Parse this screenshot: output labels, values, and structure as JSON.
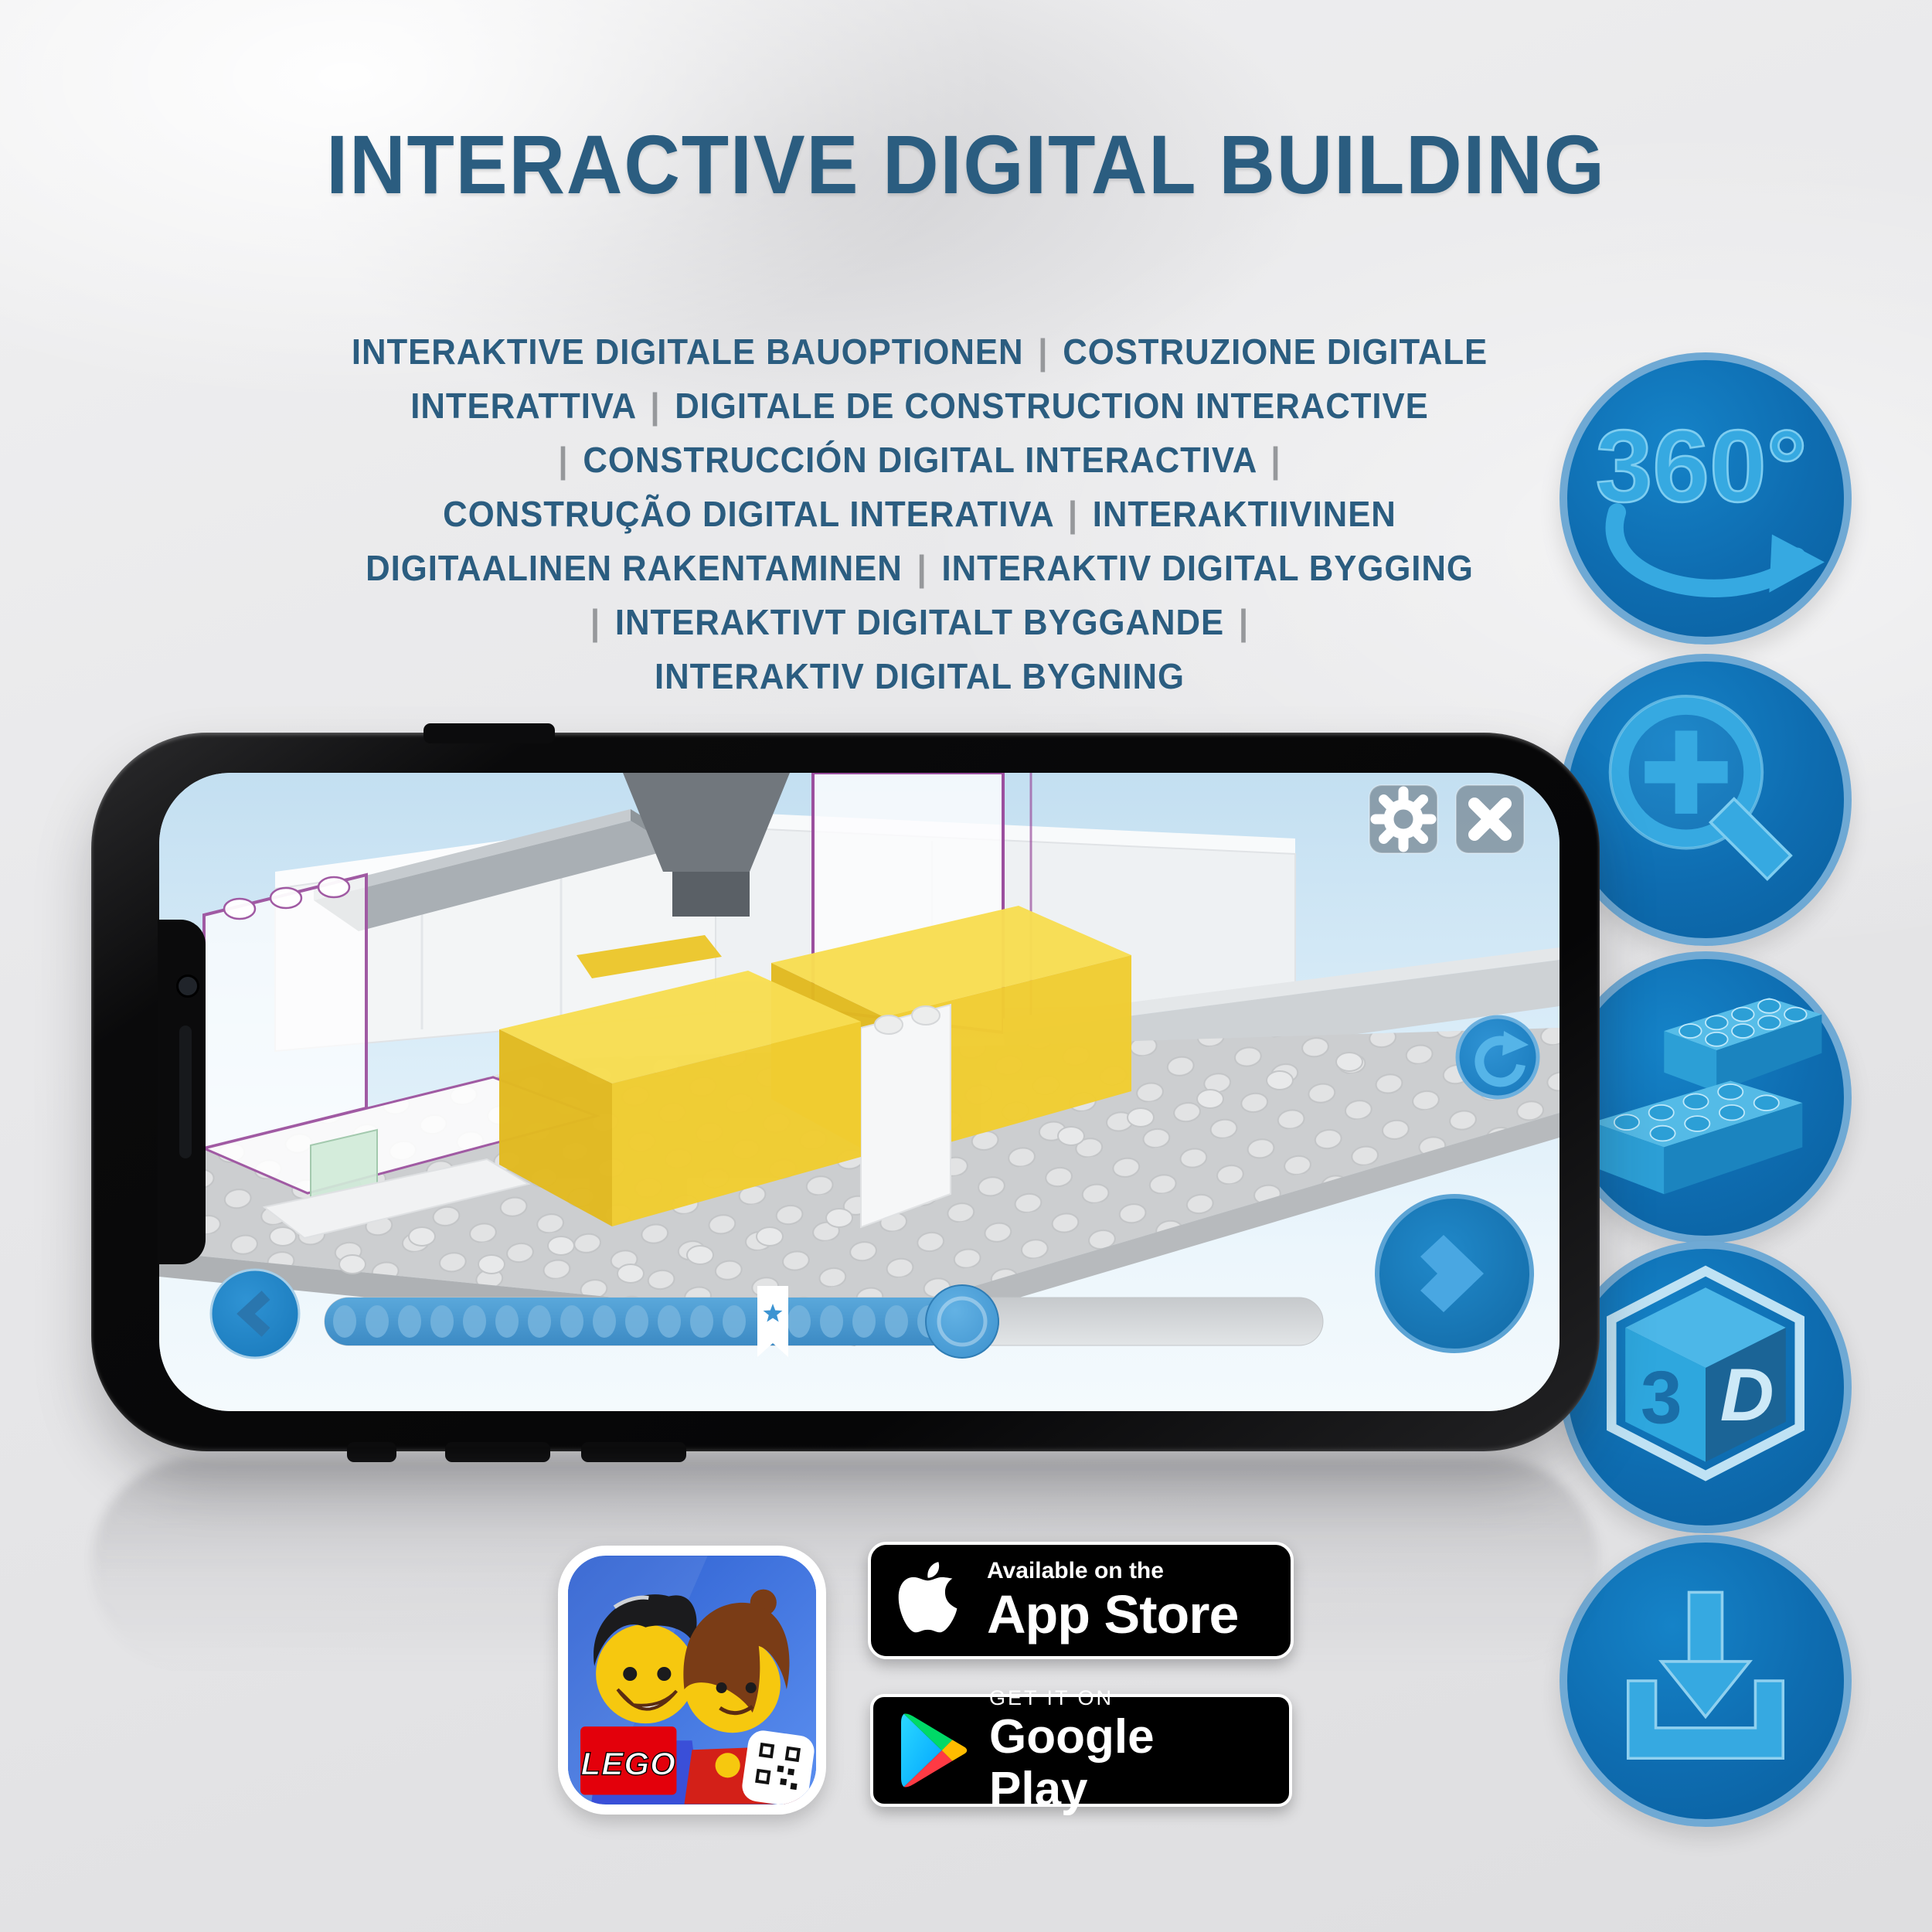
{
  "title": "INTERACTIVE DIGITAL BUILDING",
  "subtitle": {
    "lines": [
      "INTERAKTIVE DIGITALE BAUOPTIONEN | COSTRUZIONE DIGITALE",
      "INTERATTIVA | DIGITALE DE CONSTRUCTION INTERACTIVE",
      "| CONSTRUCCIÓN DIGITAL INTERACTIVA |",
      "CONSTRUÇÃO DIGITAL INTERATIVA | INTERAKTIIVINEN",
      "DIGITAALINEN RAKENTAMINEN | INTERAKTIV DIGITAL BYGGING",
      "| INTERAKTIVT DIGITALT BYGGANDE |",
      "INTERAKTIV DIGITAL BYGNING"
    ]
  },
  "features": [
    {
      "icon": "rotate-360-icon",
      "label": "360°"
    },
    {
      "icon": "zoom-in-icon",
      "label": ""
    },
    {
      "icon": "brick-icon",
      "label": ""
    },
    {
      "icon": "3d-cube-icon",
      "label_left": "3",
      "label_right": "D"
    },
    {
      "icon": "download-icon",
      "label": ""
    }
  ],
  "phone_app": {
    "controls": [
      "settings-button",
      "close-button",
      "rotate-reset-button",
      "back-button",
      "next-button",
      "progress-slider"
    ]
  },
  "store": {
    "app_store": {
      "prefix": "Available on the",
      "name": "App Store"
    },
    "google_play": {
      "prefix": "GET IT ON",
      "name": "Google Play"
    }
  },
  "app_icon": {
    "lego_logo": "LEGO"
  },
  "colors": {
    "title_text": "#2b5d80",
    "separator_gray": "#96989b",
    "feature_circle_fill": "#0e6cb0",
    "feature_circle_rim": "#6fa9d4",
    "feature_glyph_blue": "#36a9e1",
    "app_ui_blue": "#3f93cf",
    "screen_background": "#d9ecf8",
    "brick_outline_purple": "#9b4f9e",
    "brick_yellow": "#f1cd31",
    "badge_background": "#000000"
  }
}
